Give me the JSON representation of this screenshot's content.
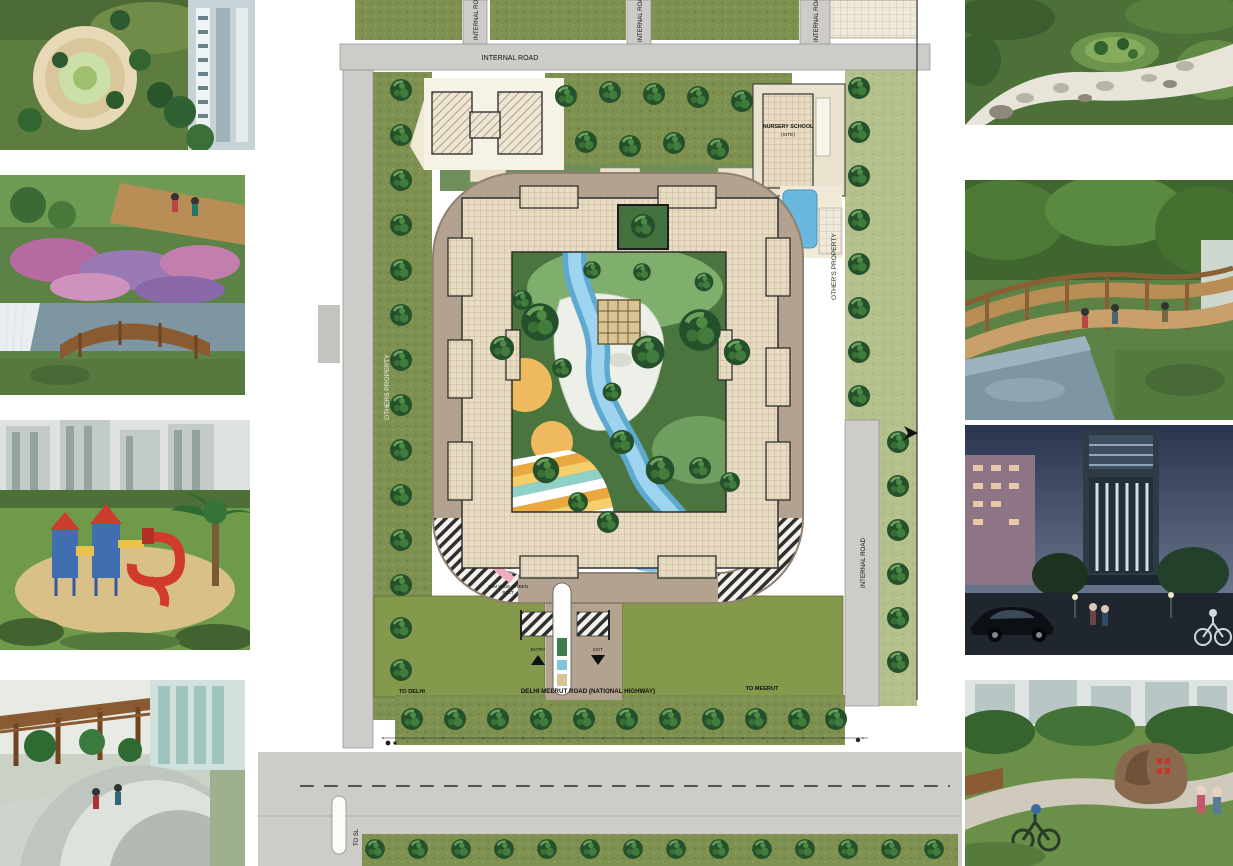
{
  "page": {
    "title": "Residential township master plan with landscape photo insets"
  },
  "plan": {
    "labels": {
      "internal_road_top": "INTERNAL ROAD",
      "internal_road_vertical": "INTERNAL ROAD",
      "internal_road_right": "INTERNAL ROAD",
      "others_property_left": "OTHERS PROPERTY",
      "others_property_right": "OTHER'S PROPERTY",
      "nursery_school_line1": "NURSERY SCHOOL",
      "nursery_school_line2": "(SITE)",
      "green_belt_line1": "30M WIDE GREEN",
      "green_belt_line2": "BELT",
      "entry": "ENTRY",
      "exit": "EXIT",
      "highway": "DELHI MEERUT ROAD (NATIONAL HIGHWAY)",
      "to_delhi": "TO DELHI",
      "to_meerut": "TO MEERUT",
      "to_sl": "TO SL"
    }
  },
  "colors": {
    "road_gray": "#cdccc8",
    "road_edge": "#8f8f8a",
    "lawn_olive": "#7e9150",
    "lawn_bright": "#85994d",
    "strip_light": "#b4c18c",
    "tree_dark": "#24512b",
    "ring_road_tan": "#b3a290",
    "building_beige": "#e8dcc4",
    "water_blue": "#7fc4e6",
    "pool_blue": "#6ab7e0",
    "sand_orange": "#efb95e",
    "rock_white": "#edefe9",
    "deck_yellow": "#f5cf6b",
    "deck_orange": "#e9a93f",
    "path_pink": "#efadc0",
    "courtyard_green": "#4a753e"
  },
  "photos": {
    "left": [
      {
        "name": "circular-garden-aerial"
      },
      {
        "name": "flower-garden-wooden-bridge"
      },
      {
        "name": "children-playground-red-slide"
      },
      {
        "name": "pergola-plaza-palms"
      }
    ],
    "right": [
      {
        "name": "pebble-stream-rock-garden"
      },
      {
        "name": "long-pergola-pool-walkway"
      },
      {
        "name": "night-waterfall-tower"
      },
      {
        "name": "park-landmark-rock-cyclists"
      }
    ]
  }
}
